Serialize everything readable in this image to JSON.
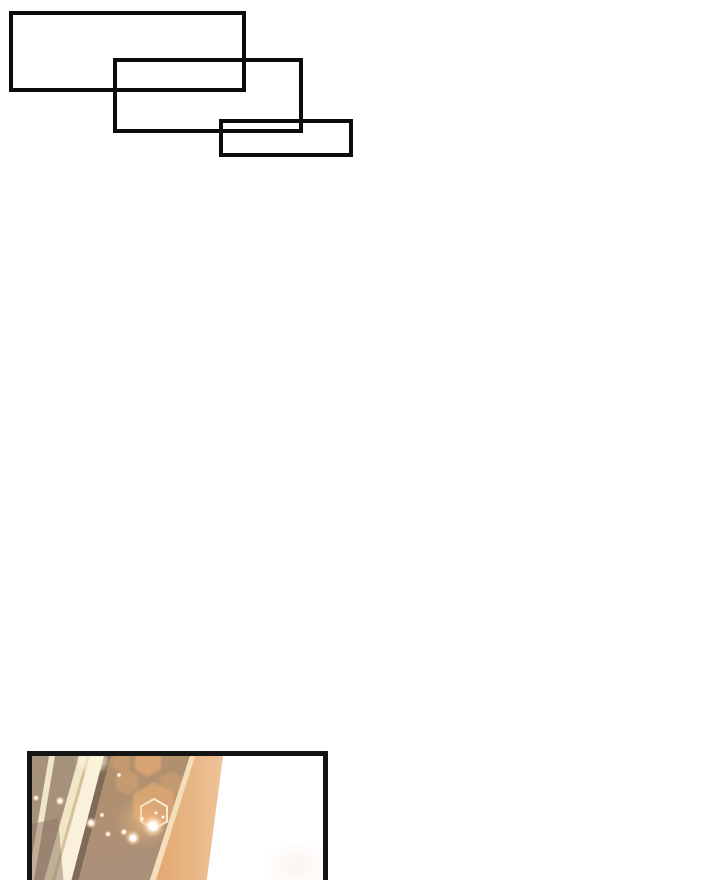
{
  "page": {
    "width": 720,
    "height": 864,
    "description": "Webtoon comic page fragment: three empty rectangular caption boxes at top-left, blank white middle, and a cropped panel at bottom-left showing a blurred golden doorway with light streaks, hexagonal bokeh and sparkles"
  },
  "caption_boxes": [
    {
      "name": "caption-box-1",
      "text": ""
    },
    {
      "name": "caption-box-2",
      "text": ""
    },
    {
      "name": "caption-box-3",
      "text": ""
    }
  ],
  "panel": {
    "description": "Cropped comic panel: warm golden blurred interior with diagonal cream light streaks on a taupe wall, a bright orange door edge, hexagonal light bokeh and white sparkles, fading to white on the right; panel is cut off by the bottom of the page"
  },
  "colors": {
    "page_bg": "#ffffff",
    "box_border": "#0c0c0c",
    "panel_border": "#141414",
    "white": "#ffffff",
    "taupe": "#a6917d",
    "taupe_dark": "#8d7866",
    "cream": "#f2e6c9",
    "cream_bright": "#f9f1dc",
    "tan_line": "#d8c29c",
    "brown_top": "#b3906a",
    "brown_bottom": "#aa8f7a",
    "brown_dark": "#7f6b57",
    "hex_orange": "#e0a873",
    "band_orange": "#e2a76f",
    "band_orange_light": "#eec298",
    "band_edge": "#f4dfba",
    "sparkle_core": "#ffffff",
    "sparkle_halo": "#ffd9a8"
  }
}
